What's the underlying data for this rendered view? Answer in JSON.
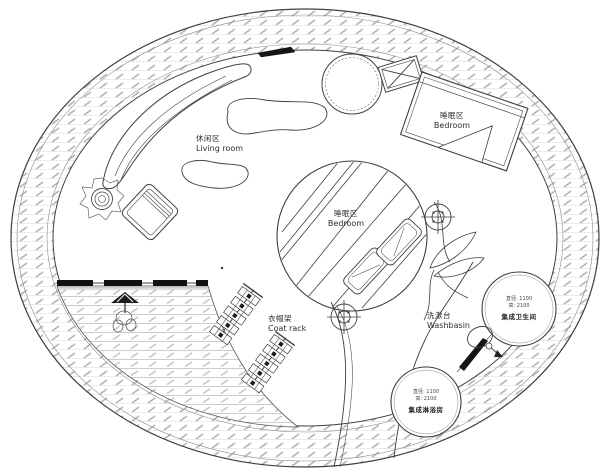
{
  "labels": {
    "living_room": {
      "zh": "休闲区",
      "en": "Living room"
    },
    "bedroom_upper": {
      "zh": "睡眠区",
      "en": "Bedroom"
    },
    "bedroom_center": {
      "zh": "睡眠区",
      "en": "Bedroom"
    },
    "coat_rack": {
      "zh": "衣帽架",
      "en": "Coat rack"
    },
    "washbasin": {
      "zh": "洗漱台",
      "en": "Washbasin"
    },
    "bathroom_pod": {
      "dim_diameter": "直径: 1100",
      "dim_height": "高: 2100",
      "name": "集成卫生间"
    },
    "shower_pod": {
      "dim_diameter": "直径: 1100",
      "dim_height": "高: 2100",
      "name": "集成淋浴房"
    }
  },
  "colors": {
    "line": "#3f3f3f",
    "hatch_gray": "#b3b3b3",
    "fill_dark": "#1a1a1a",
    "background": "#ffffff"
  }
}
